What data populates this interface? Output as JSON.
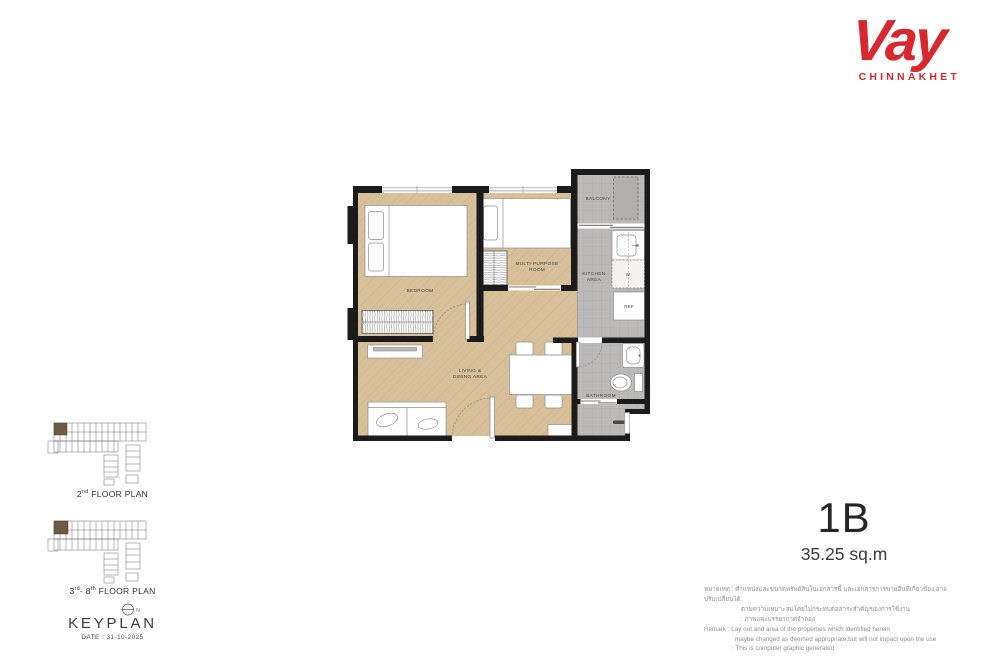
{
  "logo": {
    "name": "Vay",
    "sub": "CHINNAKHET"
  },
  "unit": {
    "code": "1B",
    "area": "35.25 sq.m"
  },
  "plan": {
    "labels": {
      "bedroom": "BEDROOM",
      "multipurpose_1": "MULTI-PURPOSE",
      "multipurpose_2": "ROOM",
      "living_1": "LIVING &",
      "living_2": "DINING AREA",
      "balcony": "BALCONY",
      "kitchen_1": "KITCHEN",
      "kitchen_2": "AREA",
      "bathroom": "BATHROOM",
      "washer": "W",
      "fridge": "REF"
    }
  },
  "keyplan": {
    "title": "KEYPLAN",
    "date": "DATE : 31-10-2025",
    "north": "N",
    "plans": [
      {
        "num": "2",
        "sup": "nd",
        "mid": "",
        "sup2": "",
        "rest": " FLOOR PLAN"
      },
      {
        "num": "3",
        "sup": "rd",
        "mid": "- 8",
        "sup2": "th",
        "rest": " FLOOR PLAN"
      }
    ]
  },
  "disclaimer": {
    "lines": [
      "หมายเหตุ : ตำแหน่งและขนาดทรัพย์สินในเอกสารนี้ และเอกสารการขายอื่นที่เกี่ยวข้อง อาจปรับเปลี่ยนได้",
      "ตามความเหมาะสมโดยไม่กระทบต่อสาระสำคัญของการใช้งาน",
      ": ภาพและบรรยากาศจำลอง",
      "Remark : Lay out and area of the properties which identified herein",
      "maybe changed as deemed appropriate,but will not impact upon the use",
      ": This is computer graphic generated"
    ]
  },
  "colors": {
    "brand": "#d7282e",
    "wood": "#d8c09a",
    "tile": "#bcbab8",
    "wall": "#1b1b1b",
    "keyplan_highlight": "#6d5c44"
  }
}
